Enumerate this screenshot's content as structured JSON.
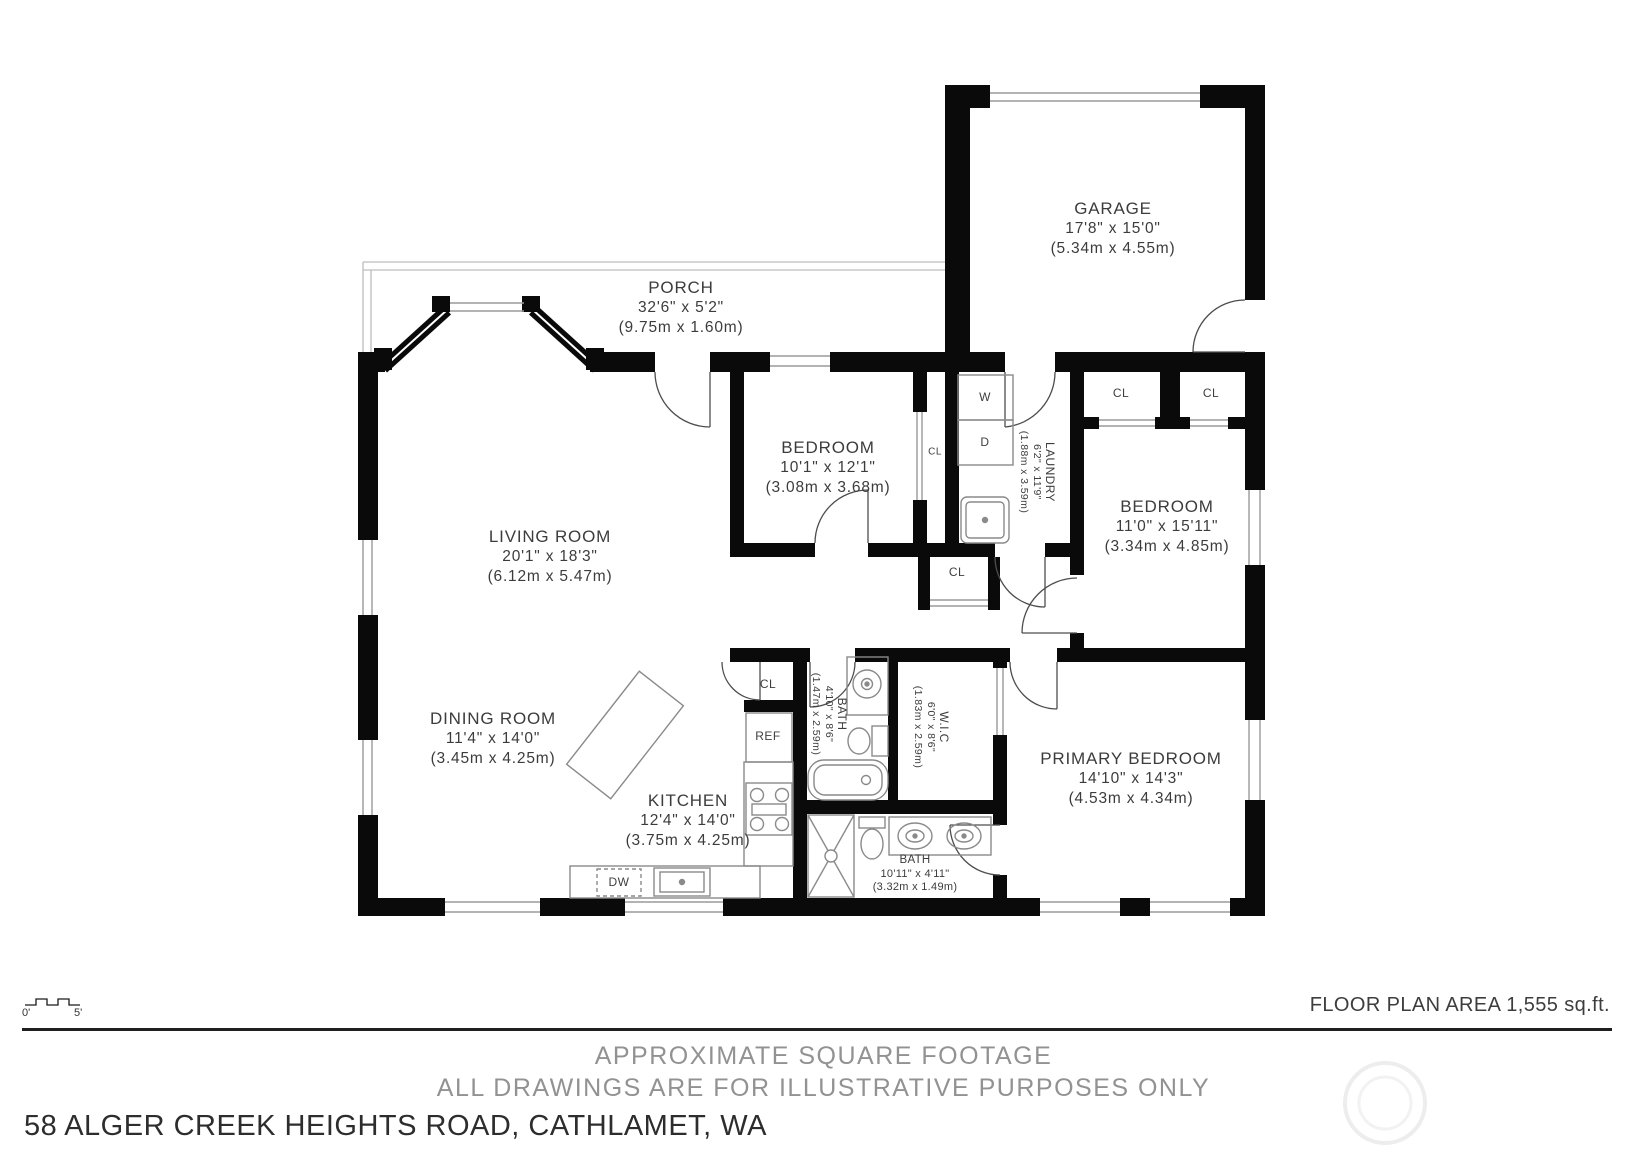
{
  "title_block": {
    "address": "58 ALGER CREEK HEIGHTS ROAD, CATHLAMET, WA",
    "area_note": "FLOOR PLAN AREA 1,555 sq.ft.",
    "disclaimer_line1": "APPROXIMATE SQUARE FOOTAGE",
    "disclaimer_line2": "ALL DRAWINGS ARE FOR ILLUSTRATIVE PURPOSES ONLY"
  },
  "scale_bar": {
    "start_label": "0'",
    "end_label": "5'"
  },
  "rooms": [
    {
      "name": "GARAGE",
      "dims": "17'8\" x 15'0\"",
      "metric": "(5.34m x 4.55m)"
    },
    {
      "name": "PORCH",
      "dims": "32'6\" x 5'2\"",
      "metric": "(9.75m x 1.60m)"
    },
    {
      "name": "BEDROOM",
      "dims": "10'1\" x 12'1\"",
      "metric": "(3.08m x 3.68m)"
    },
    {
      "name": "LAUNDRY",
      "dims": "6'2\" x 11'9\"",
      "metric": "(1.88m x 3.59m)"
    },
    {
      "name": "BEDROOM",
      "dims": "11'0\" x 15'11\"",
      "metric": "(3.34m x 4.85m)"
    },
    {
      "name": "LIVING ROOM",
      "dims": "20'1\" x 18'3\"",
      "metric": "(6.12m x 5.47m)"
    },
    {
      "name": "DINING ROOM",
      "dims": "11'4\" x 14'0\"",
      "metric": "(3.45m x 4.25m)"
    },
    {
      "name": "KITCHEN",
      "dims": "12'4\" x 14'0\"",
      "metric": "(3.75m x 4.25m)"
    },
    {
      "name": "BATH",
      "dims": "4'10\" x 8'6\"",
      "metric": "(1.47m x 2.59m)"
    },
    {
      "name": "W.I.C",
      "dims": "6'0\" x 8'6\"",
      "metric": "(1.83m x 2.59m)"
    },
    {
      "name": "PRIMARY BEDROOM",
      "dims": "14'10\" x 14'3\"",
      "metric": "(4.53m x 4.34m)"
    },
    {
      "name": "BATH",
      "dims": "10'11\" x 4'11\"",
      "metric": "(3.32m x 1.49m)"
    }
  ],
  "fixtures": {
    "closet": "CL",
    "washer": "W",
    "dryer": "D",
    "refrigerator": "REF",
    "dishwasher": "DW"
  },
  "colors": {
    "wall": "#0a0a0a",
    "label": "#3c3c3c",
    "muted_text": "#929292",
    "fixture_stroke": "#8a8a8a",
    "window_stroke": "#9a9a9a"
  }
}
